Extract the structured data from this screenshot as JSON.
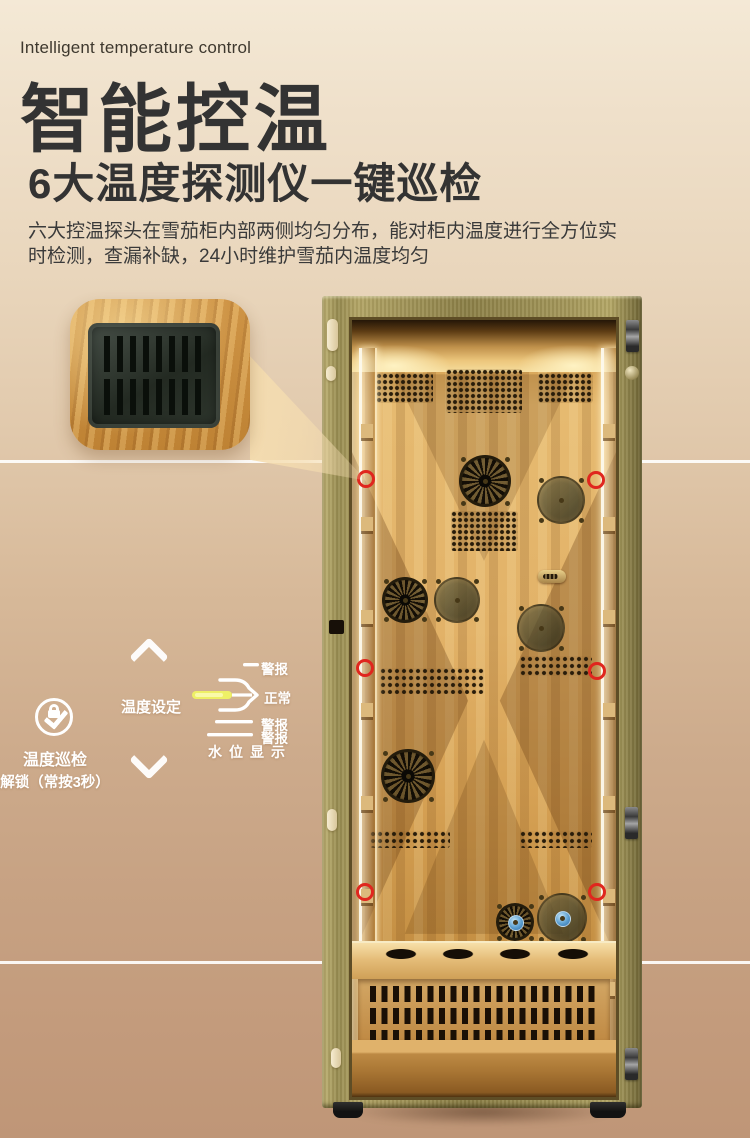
{
  "header": {
    "eyebrow": "Intelligent temperature control",
    "title": "智能控温",
    "subtitle": "6大温度探测仪一键巡检",
    "description_line1": "六大控温探头在雪茄柜内部两侧均匀分布，能对柜内温度进行全方位实",
    "description_line2": "时检测，查漏补缺，24小时维护雪茄内温度均匀"
  },
  "controls": {
    "patrol_label": "温度巡检",
    "unlock_label": "解锁（常按3秒）",
    "temp_setting_label": "温度设定"
  },
  "water_level_diagram": {
    "alarm_top": "警报",
    "normal": "正常",
    "alarm_mid": "警报",
    "alarm_low": "警报",
    "caption": "水位显示"
  },
  "product": {
    "sensor_marker_count": 6
  },
  "icons": {
    "chevron_up": "chevron-up (CSS angle shape)",
    "chevron_down": "chevron-down (CSS angle shape)",
    "patrol_unlock": "lock-with-check in circle (CSS shapes)",
    "sensor_marker": "red outline circle"
  },
  "colors": {
    "accent_red": "#e0261e",
    "water_level_yellow": "#eef066",
    "frame_gold": "#a3965a",
    "interior_wood": "#dcae62",
    "heading_text": "#333333",
    "annotation_text": "#ffffff",
    "divider": "#ffffff"
  }
}
